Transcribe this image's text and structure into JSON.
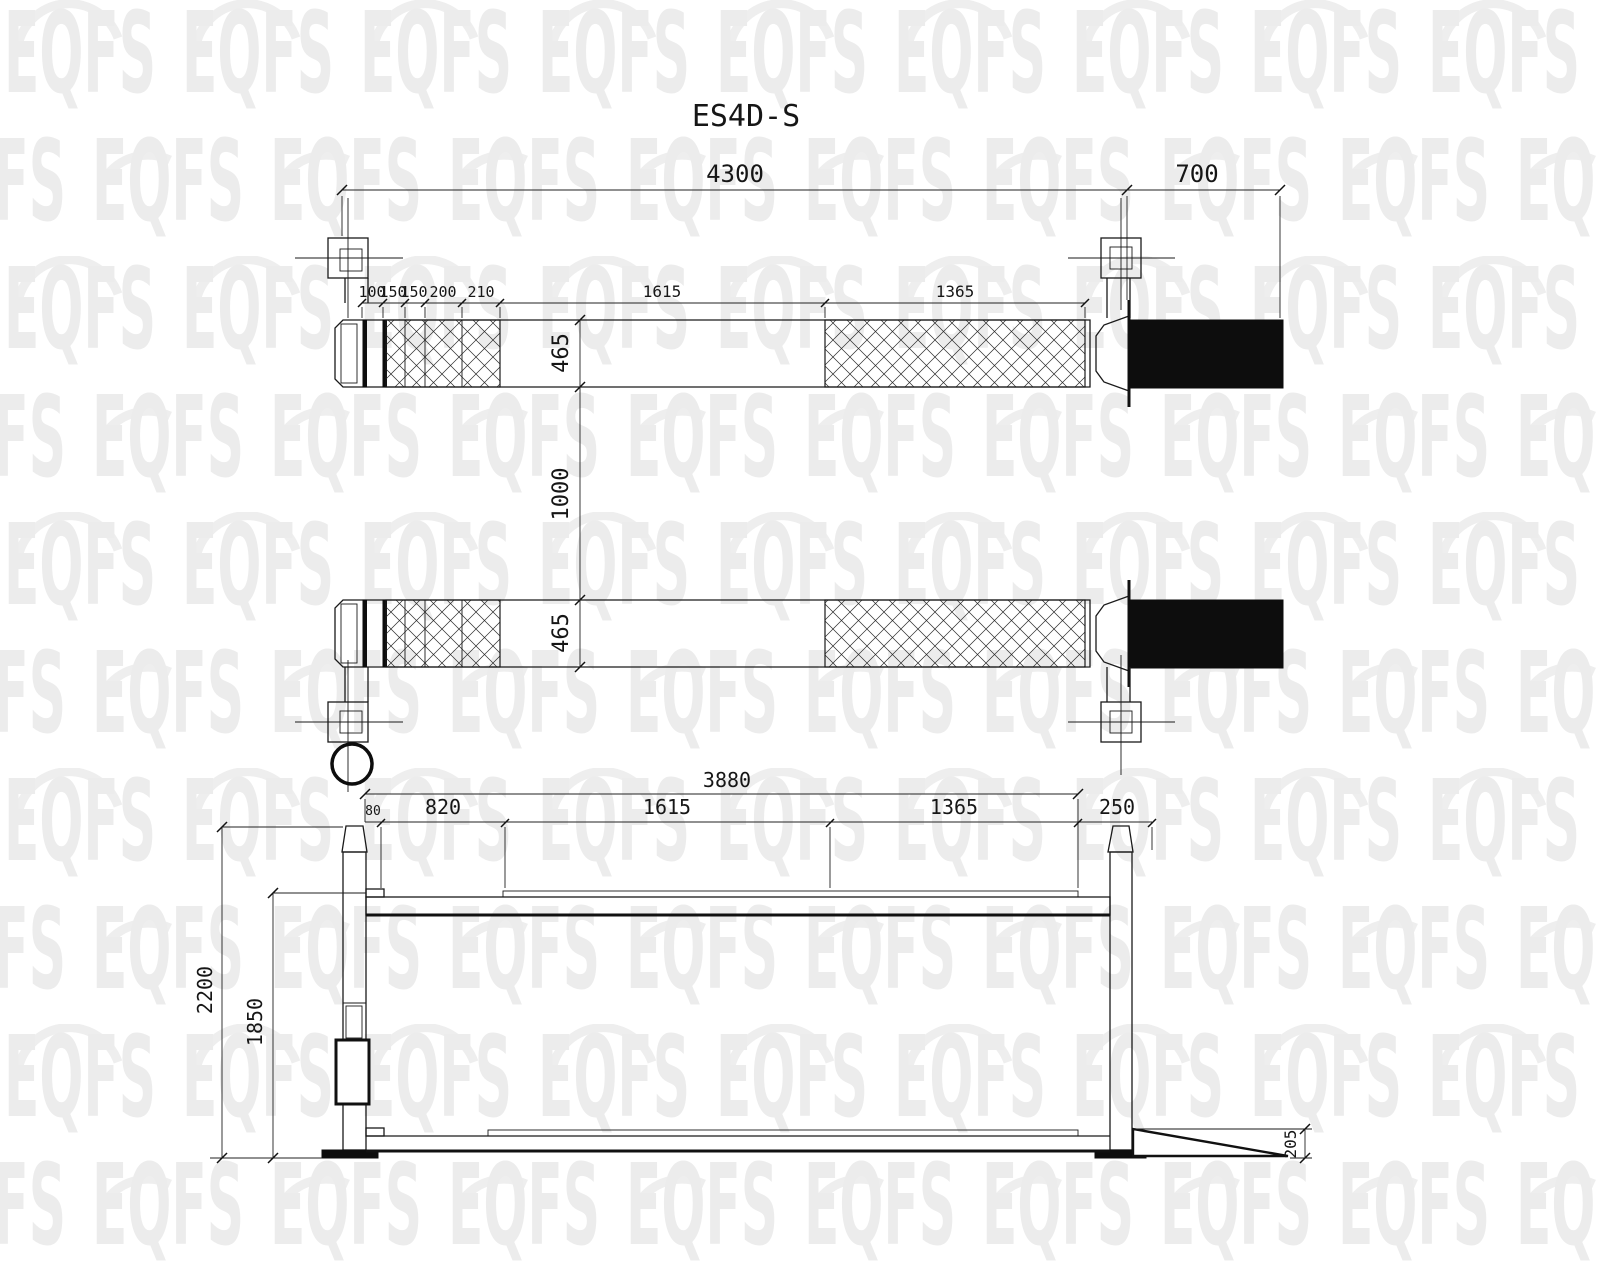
{
  "title": "ES4D-S",
  "watermark": {
    "text": "EQFS"
  },
  "top_view": {
    "dims": {
      "overall": "4300",
      "ramp": "700",
      "seg1": "100",
      "seg2": "150",
      "seg3": "150",
      "seg4": "200",
      "seg5": "210",
      "mid": "1615",
      "right": "1365",
      "runway_top_width": "465",
      "gap": "1000",
      "runway_bottom_width": "465"
    }
  },
  "side_view": {
    "dims": {
      "overall": "3880",
      "s80": "80",
      "s820": "820",
      "s1615": "1615",
      "s1365": "1365",
      "s250": "250",
      "h2200": "2200",
      "h1850": "1850",
      "ramp_h": "205"
    }
  }
}
